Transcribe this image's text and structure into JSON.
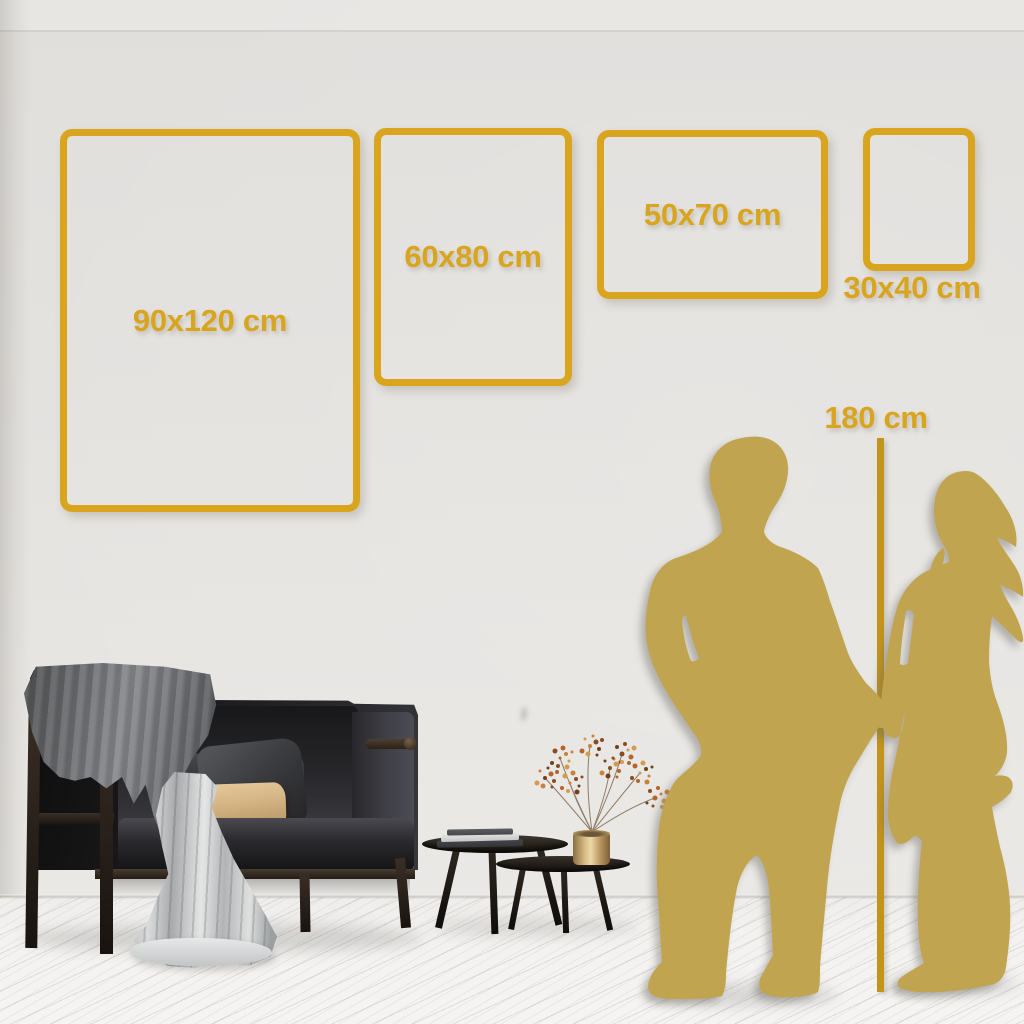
{
  "size_guide": {
    "frames": [
      {
        "label": "90x120 cm",
        "width_cm": 90,
        "height_cm": 120
      },
      {
        "label": "60x80 cm",
        "width_cm": 60,
        "height_cm": 80
      },
      {
        "label": "50x70 cm",
        "width_cm": 50,
        "height_cm": 70
      },
      {
        "label": "30x40 cm",
        "width_cm": 30,
        "height_cm": 40
      }
    ],
    "height_reference": {
      "label": "180 cm",
      "value_cm": 180
    }
  },
  "colors": {
    "gold": "#D9A51E",
    "line_gold": "#C3941A",
    "silhouette_gold": "#C1A44F"
  },
  "scene": {
    "elements": [
      "sofa",
      "throw-blanket",
      "cushions",
      "nesting-coffee-tables",
      "books",
      "brass-vase",
      "dried-branch",
      "man-silhouette",
      "woman-silhouette",
      "wood-floor",
      "wall"
    ]
  }
}
